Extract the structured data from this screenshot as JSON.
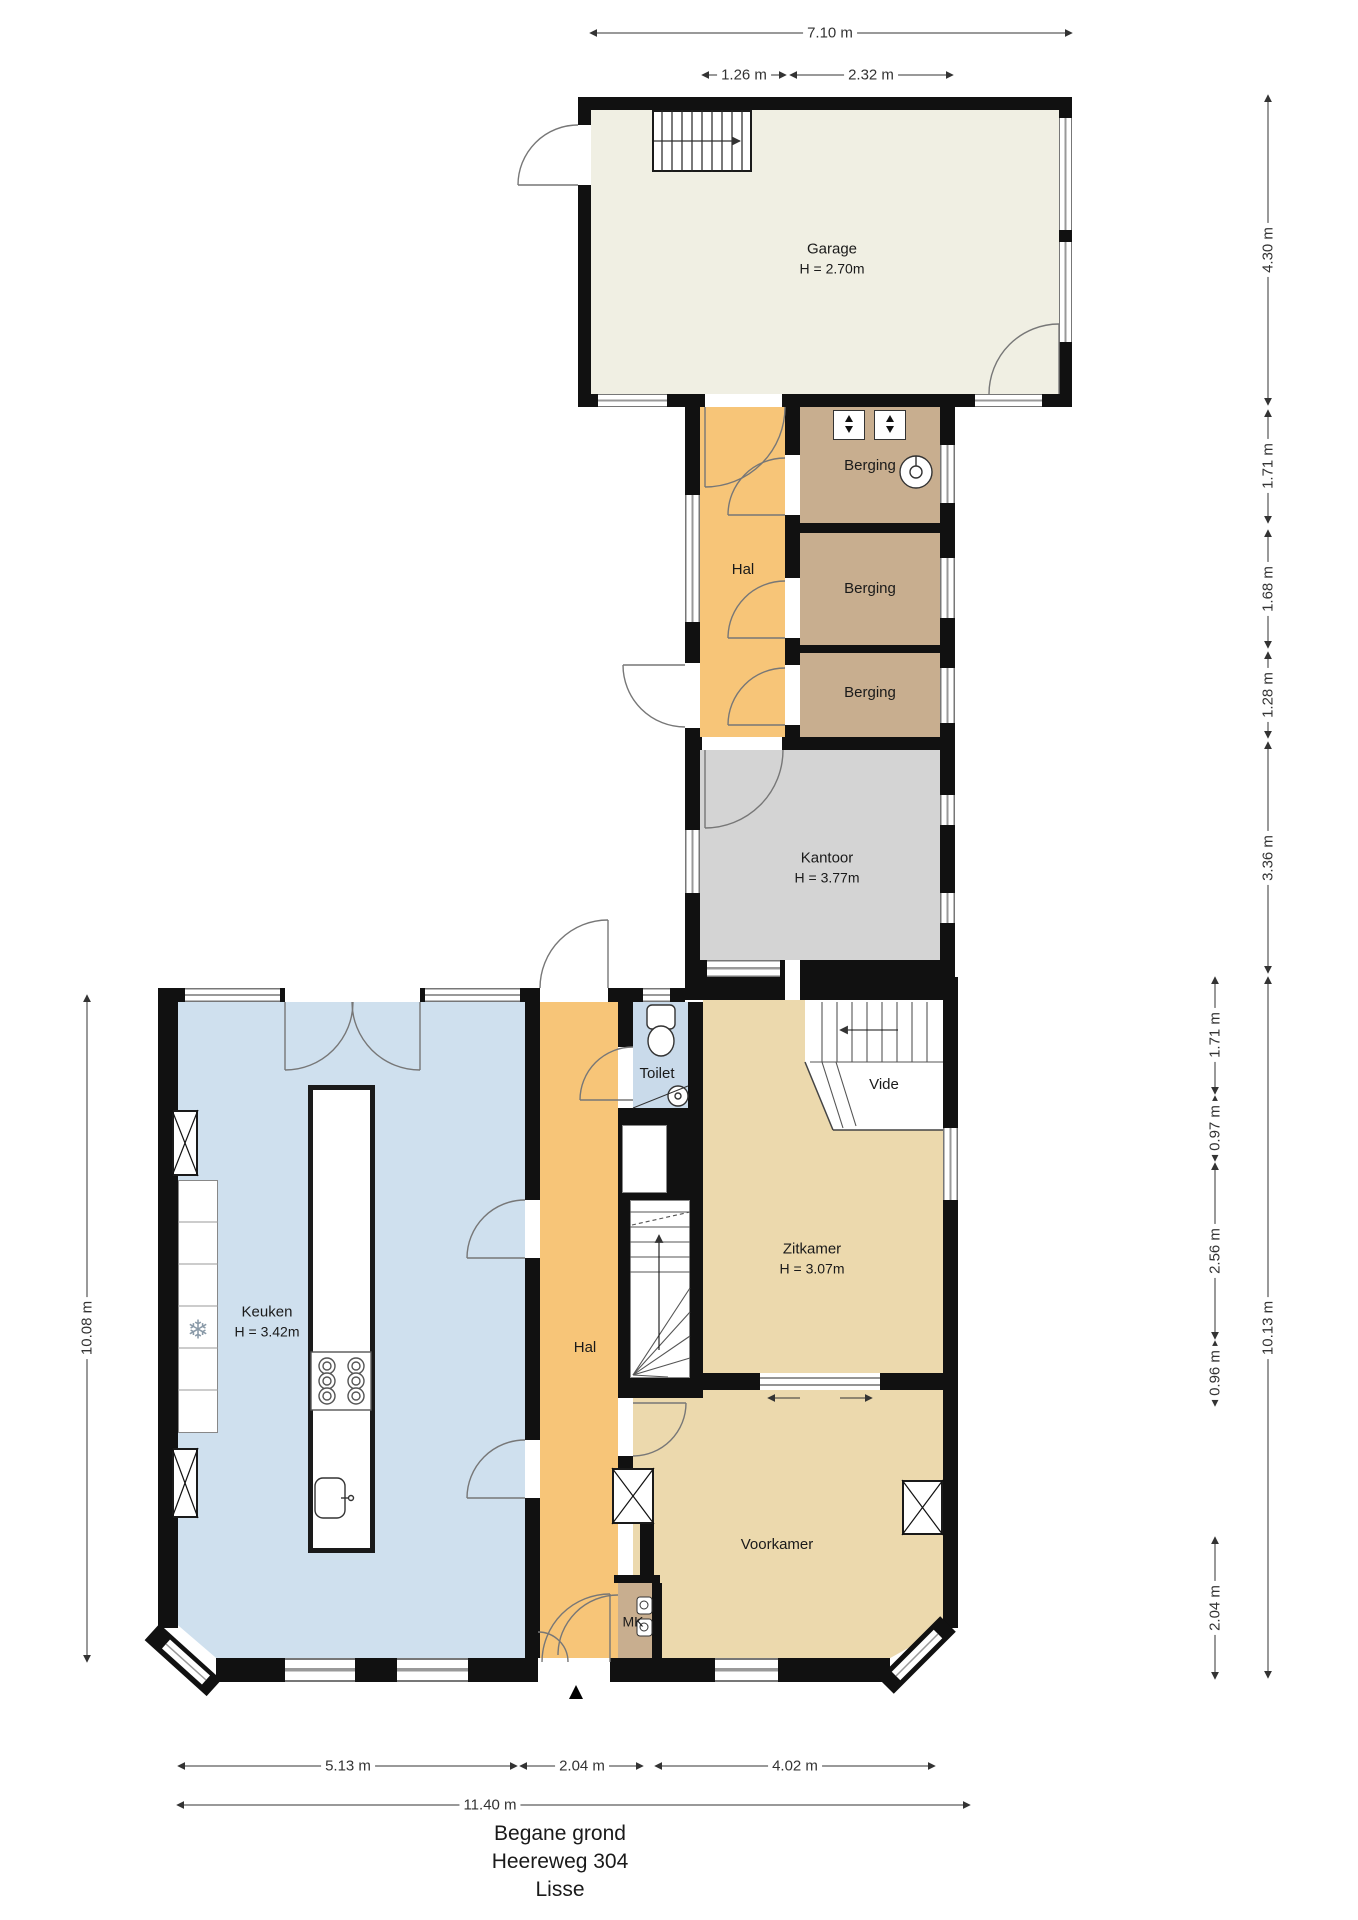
{
  "plan": {
    "rooms": {
      "garage": {
        "label": "Garage",
        "height": "H = 2.70m"
      },
      "hal_upper": {
        "label": "Hal"
      },
      "berging_1": {
        "label": "Berging"
      },
      "berging_2": {
        "label": "Berging"
      },
      "berging_3": {
        "label": "Berging"
      },
      "kantoor": {
        "label": "Kantoor",
        "height": "H = 3.77m"
      },
      "keuken": {
        "label": "Keuken",
        "height": "H = 3.42m"
      },
      "hal_lower": {
        "label": "Hal"
      },
      "toilet": {
        "label": "Toilet"
      },
      "vide": {
        "label": "Vide"
      },
      "zitkamer": {
        "label": "Zitkamer",
        "height": "H = 3.07m"
      },
      "voorkamer": {
        "label": "Voorkamer"
      },
      "meterkast": {
        "label": "MK"
      }
    },
    "dimensions": {
      "top": {
        "total": "7.10 m",
        "hal": "1.26 m",
        "berging": "2.32 m"
      },
      "right_upper": [
        "4.30 m",
        "1.71 m",
        "1.68 m",
        "1.28 m",
        "3.36 m"
      ],
      "right_lower": {
        "parts": [
          "1.71 m",
          "0.97 m",
          "2.56 m",
          "0.96 m",
          "2.04 m"
        ],
        "total": "10.13 m"
      },
      "left": {
        "total": "10.08 m"
      },
      "bottom": {
        "keuken": "5.13 m",
        "hal": "2.04 m",
        "voorkamer": "4.02 m",
        "total": "11.40 m"
      }
    },
    "footer": {
      "floor": "Begane grond",
      "street": "Heereweg 304",
      "city": "Lisse"
    },
    "icons": {
      "entrance_marker": "▲",
      "freezer": "❄"
    },
    "colors": {
      "wall": "#111111",
      "garage": "#f0efe3",
      "hal": "#f7c578",
      "berging": "#c8ae8f",
      "kantoor": "#d4d4d4",
      "living": "#ecd9ad",
      "keuken": "#cfe0ee",
      "toilet": "#c9daea",
      "window": "#888888"
    }
  }
}
